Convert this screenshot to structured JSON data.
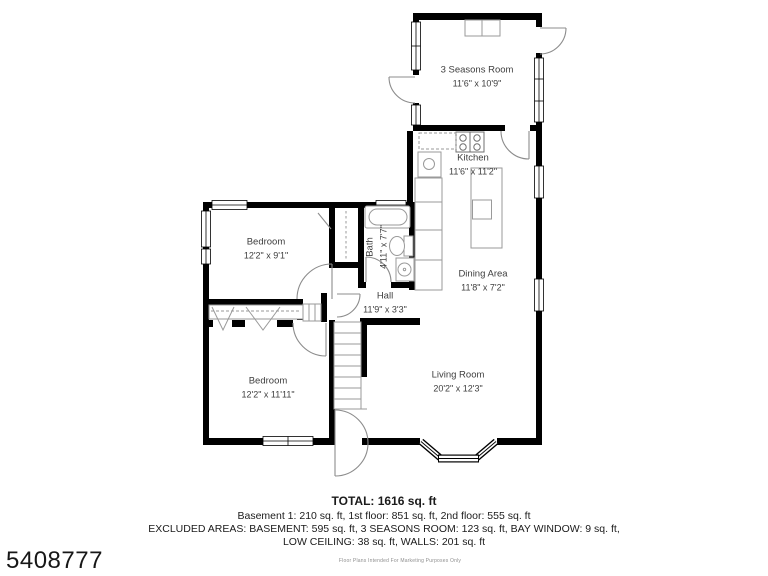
{
  "meta": {
    "listing_id": "5408777",
    "disclaimer": "Floor Plans Intended For Marketing Purposes Only"
  },
  "footer": {
    "total": "TOTAL: 1616 sq. ft",
    "floors": "Basement 1: 210 sq. ft, 1st floor: 851 sq. ft, 2nd floor: 555 sq. ft",
    "excluded_1": "EXCLUDED AREAS: BASEMENT: 595 sq. ft, 3 SEASONS ROOM: 123 sq. ft, BAY WINDOW: 9 sq. ft,",
    "excluded_2": "LOW CEILING: 38 sq. ft, WALLS: 201 sq. ft"
  },
  "rooms": [
    {
      "name": "3 Seasons Room",
      "dims": "11'6\" x 10'9\""
    },
    {
      "name": "Kitchen",
      "dims": "11'6\" x 11'2\""
    },
    {
      "name": "Bedroom",
      "dims": "12'2\" x 9'1\""
    },
    {
      "name": "Bath",
      "dims": "4'11\" x 7'7\""
    },
    {
      "name": "Hall",
      "dims": "11'9\" x 3'3\""
    },
    {
      "name": "Dining Area",
      "dims": "11'8\" x 7'2\""
    },
    {
      "name": "Bedroom",
      "dims": "12'2\" x 11'11\""
    },
    {
      "name": "Living Room",
      "dims": "20'2\" x 12'3\""
    }
  ],
  "colors": {
    "wall": "#000000",
    "background": "#ffffff",
    "label_text": "#3e3e3e",
    "fixture_line": "#9a9a9a",
    "door_line": "#8c8c8c"
  }
}
